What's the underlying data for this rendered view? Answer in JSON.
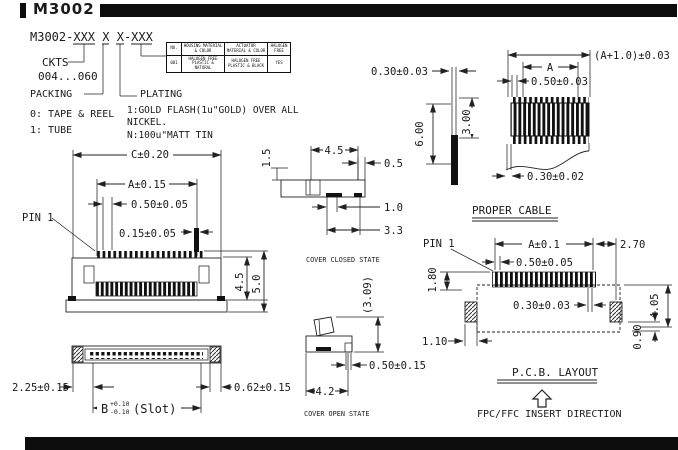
{
  "header": {
    "title": "M3002"
  },
  "part_numbering": {
    "code": "M3002-XXX X X-XXX",
    "ckts_label": "CKTS",
    "ckts_range": "004...060",
    "packing_label": "PACKING",
    "packing_option_0": "0: TAPE & REEL",
    "packing_option_1": "1: TUBE",
    "plating_label": "PLATING",
    "plating_option_1_line1": "1:GOLD FLASH(1u\"GOLD) OVER ALL",
    "plating_option_1_line2": "NICKEL.",
    "plating_option_n": "N:100u\"MATT TIN"
  },
  "materials_table": {
    "header": {
      "no": "NO.",
      "housing": "HOUSING MATERIAL & COLOR",
      "actuator": "ACTUATOR MATERIAL & COLOR",
      "halogen": "HALOGEN FREE"
    },
    "row": {
      "no": "001",
      "housing": "HALOGEN FREE PLASTIC & NATURAL",
      "actuator": "HALOGEN FREE PLASTIC & BLACK",
      "halogen": "YES"
    }
  },
  "front_view": {
    "pin1_label": "PIN 1",
    "dim_width_total": "C±0.20",
    "dim_width_a": "A±0.15",
    "dim_pitch": "0.50±0.05",
    "dim_pin": "0.15±0.05",
    "dim_height_body": "4.5",
    "dim_height_total": "5.0"
  },
  "bottom_view": {
    "dim_end": "2.25±0.15",
    "dim_tab": "0.62±0.15",
    "dim_slot_letter": "B",
    "dim_slot_tol_plus": "+0.10",
    "dim_slot_tol_minus": "-0.10",
    "dim_slot_suffix": "(Slot)"
  },
  "cover_closed_view": {
    "title": "COVER CLOSED STATE",
    "dim_left": "1.5",
    "dim_top": "4.5",
    "dim_r1": "0.5",
    "dim_r2": "1.0",
    "dim_r3": "3.3"
  },
  "cable_section_view": {
    "dim_thickness": "0.30±0.03",
    "dim_length": "6.00",
    "dim_exposed": "3.00"
  },
  "proper_cable_view": {
    "title": "PROPER CABLE",
    "dim_total": "(A+1.0)±0.03",
    "dim_a": "A",
    "dim_pitch": "0.50±0.03",
    "dim_conductor": "0.30±0.02"
  },
  "cover_open_view": {
    "title": "COVER OPEN STATE",
    "dim_height": "(3.09)",
    "dim_tail": "0.50±0.15",
    "dim_depth": "4.2"
  },
  "pcb_layout_view": {
    "title": "P.C.B. LAYOUT",
    "pin1_label": "PIN 1",
    "dim_a": "A±0.1",
    "dim_edge": "2.70",
    "dim_pitch": "0.50±0.05",
    "dim_pad_len": "1.80",
    "dim_pad_w": "0.30±0.03",
    "dim_span": "4.05",
    "dim_pad_h": "0.90",
    "dim_anchor_w": "1.10",
    "insert_note": "FPC/FFC INSERT DIRECTION"
  },
  "colors": {
    "ink": "#1a1a1a",
    "paper": "#ffffff",
    "bar": "#0c0c0c"
  }
}
